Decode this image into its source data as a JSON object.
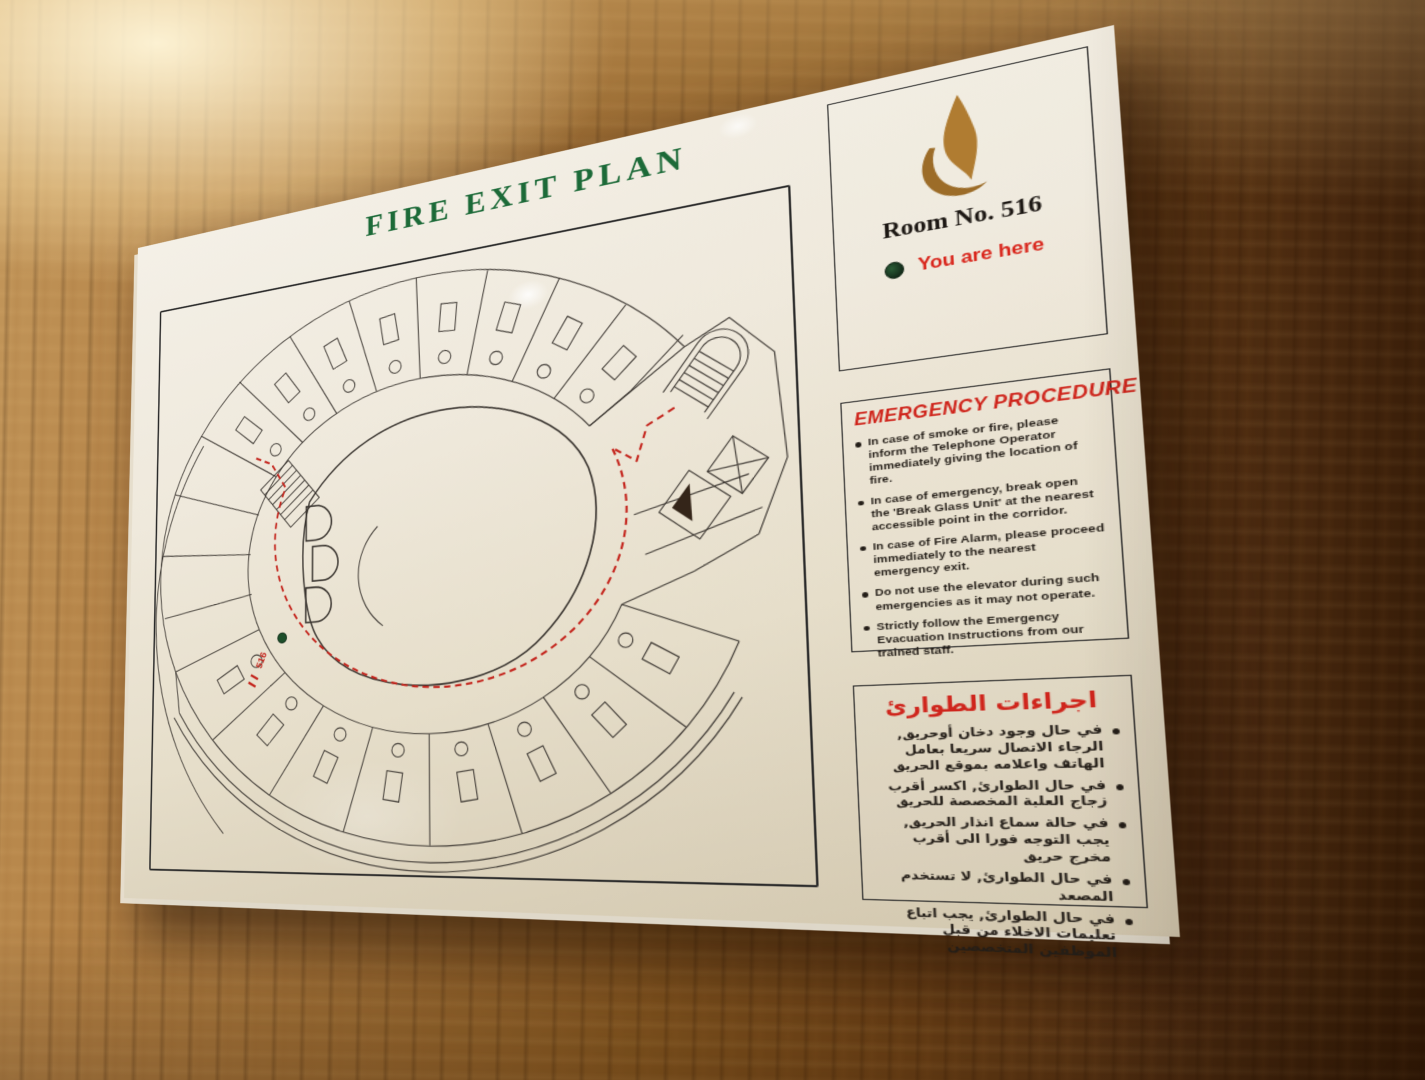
{
  "sign": {
    "title": "FIRE EXIT PLAN",
    "room_box": {
      "room_label": "Room No. 516",
      "you_are_here": "You are here"
    },
    "emergency_en": {
      "title": "EMERGENCY PROCEDURE",
      "items": [
        "In case of smoke or fire, please inform the Telephone Operator immediately giving the location of fire.",
        "In case of emergency, break open the 'Break Glass Unit' at the nearest accessible point in the corridor.",
        "In case of Fire Alarm, please proceed immediately to the nearest emergency exit.",
        "Do not use the elevator during such emergencies as it may not operate.",
        "Strictly follow the Emergency Evacuation Instructions from our trained staff."
      ]
    },
    "emergency_ar": {
      "title": "اجراءات الطوارئ",
      "items": [
        "في حال وجود دخان أوحريق, الرجاء الاتصال سريعا بعامل الهاتف واعلامه بموقع الحريق",
        "في حال الطوارئ, اكسر أقرب زجاج العلبة المخصصة للحريق",
        "في حالة سماع انذار الحريق, يجب التوجه فورا الى أقرب مخرج حريق",
        "في حال الطوارئ, لا تستخدم المصعد",
        "في حال الطوارئ, يجب اتباع تعليمات الاخلاء من قبل الموظفين المتخصصين"
      ]
    },
    "plan": {
      "marker_label": "516"
    }
  },
  "colors": {
    "title_green": "#1c6a38",
    "alert_red": "#cf251c",
    "flame_gold": "#a8762f",
    "marker_green": "#1d4f2a",
    "route_red": "#c4251d"
  }
}
